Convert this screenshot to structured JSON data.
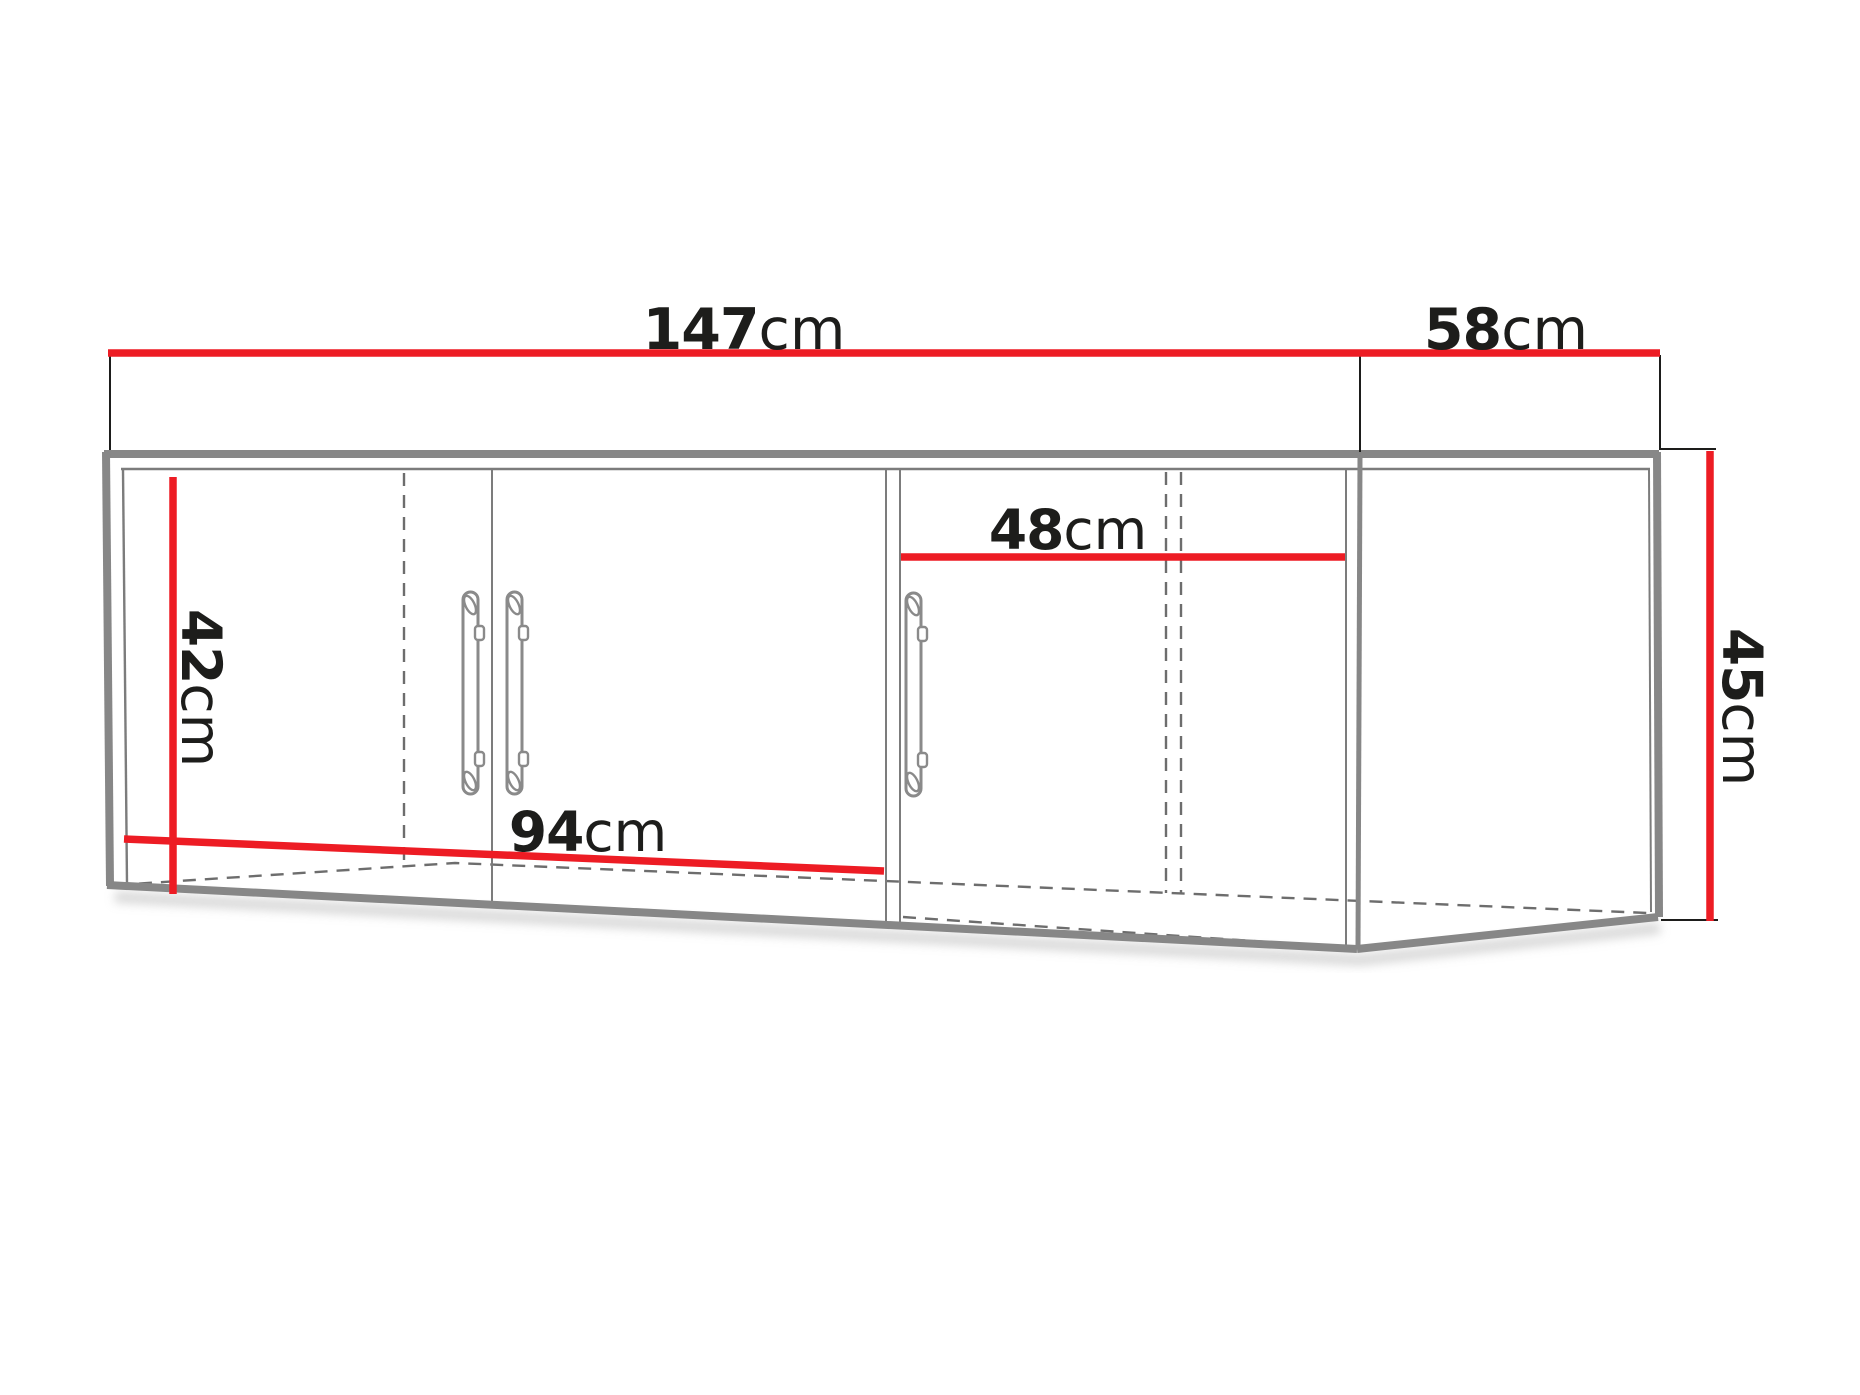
{
  "diagram": {
    "name": "corner-wall-cabinet-dimension-drawing",
    "dimensions": {
      "width_total": {
        "value": "147",
        "unit": "cm"
      },
      "width_side": {
        "value": "58",
        "unit": "cm"
      },
      "opening_width": {
        "value": "48",
        "unit": "cm"
      },
      "inner_height": {
        "value": "42",
        "unit": "cm"
      },
      "doors_width": {
        "value": "94",
        "unit": "cm"
      },
      "side_height": {
        "value": "45",
        "unit": "cm"
      }
    },
    "colors": {
      "dimension_red": "#ed1c24",
      "edge_gray": "#878787",
      "line_gray": "#7c7c7c",
      "dash_gray": "#6d6d6d",
      "text_black": "#1d1d1b"
    }
  }
}
